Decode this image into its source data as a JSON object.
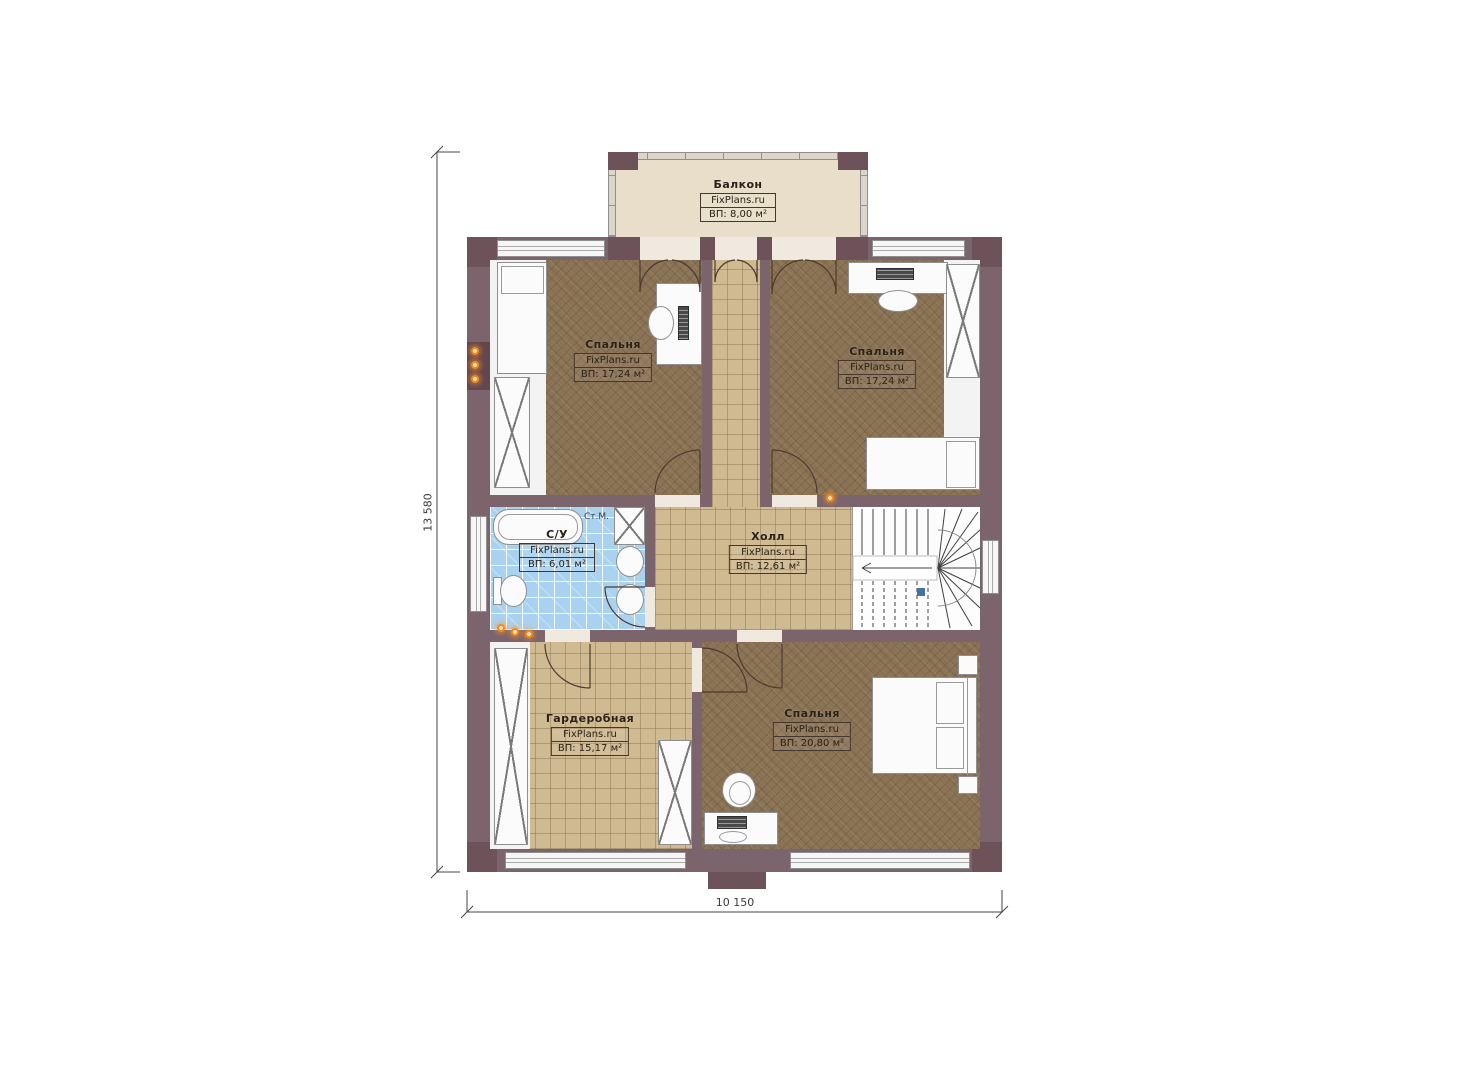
{
  "dimensions": {
    "height_label": "13 580",
    "width_label": "10 150"
  },
  "rooms": {
    "balcony": {
      "name": "Балкон",
      "brand": "FixPlans.ru",
      "area": "ВП: 8,00 м²"
    },
    "bedroom_top_left": {
      "name": "Спальня",
      "brand": "FixPlans.ru",
      "area": "ВП: 17,24 м²"
    },
    "bedroom_top_right": {
      "name": "Спальня",
      "brand": "FixPlans.ru",
      "area": "ВП: 17,24 м²"
    },
    "bathroom": {
      "name": "С/У",
      "brand": "FixPlans.ru",
      "area": "ВП: 6,01 м²"
    },
    "hall": {
      "name": "Холл",
      "brand": "FixPlans.ru",
      "area": "ВП: 12,61 м²"
    },
    "wardrobe": {
      "name": "Гардеробная",
      "brand": "FixPlans.ru",
      "area": "ВП: 15,17 м²"
    },
    "bedroom_bottom": {
      "name": "Спальня",
      "brand": "FixPlans.ru",
      "area": "ВП: 20,80 м²"
    }
  },
  "annotations": {
    "washing_machine": "Ст.М."
  },
  "colors": {
    "wall": "#7b646c",
    "wall_dark": "#6e525a",
    "carpet": "#8b7355",
    "tile": "#cfba92",
    "bath_tile": "#a9d2f0",
    "balcony_floor": "#e8dec9",
    "lamp_orange": "#f28a1e",
    "stair_marker_blue": "#4472a8"
  }
}
